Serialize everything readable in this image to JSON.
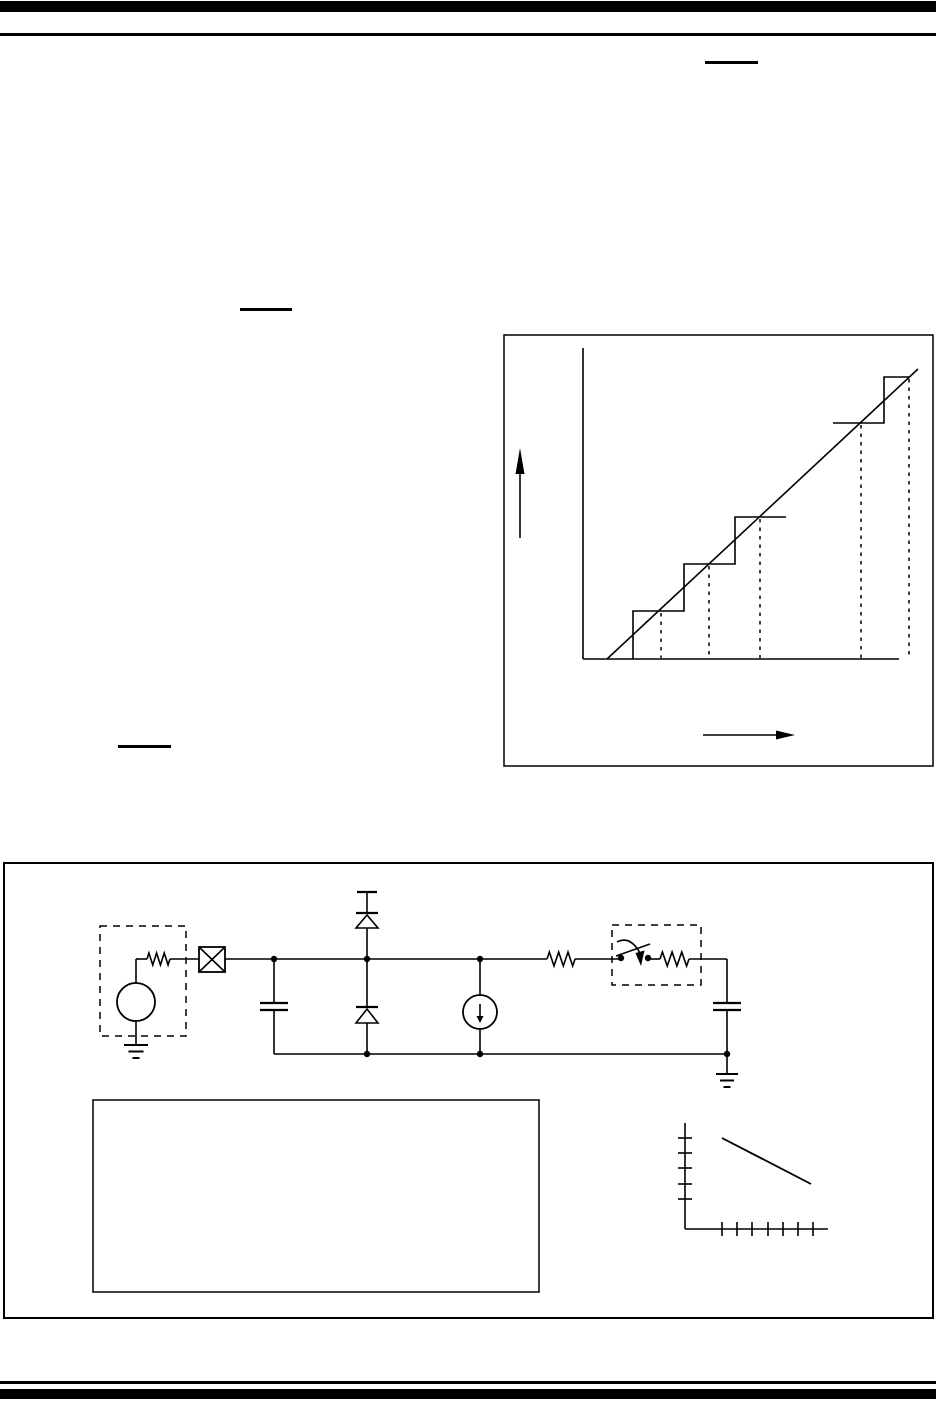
{
  "page": {
    "width": 936,
    "height": 1412,
    "background": "#ffffff",
    "ink": "#000000"
  },
  "rules": [
    {
      "name": "top-thick-bar",
      "x": 0,
      "y": 1,
      "w": 936,
      "h": 11
    },
    {
      "name": "top-thin-rule",
      "x": 0,
      "y": 33,
      "w": 936,
      "h": 3
    },
    {
      "name": "bottom-thin-rule",
      "x": 0,
      "y": 1381,
      "w": 936,
      "h": 3
    },
    {
      "name": "bottom-thick-bar",
      "x": 0,
      "y": 1389,
      "w": 936,
      "h": 10
    }
  ],
  "underlines": [
    {
      "name": "reference-underline-top-right",
      "x": 705,
      "y": 61,
      "w": 53,
      "h": 3
    },
    {
      "name": "reference-underline-mid-left",
      "x": 240,
      "y": 308,
      "w": 52,
      "h": 3
    },
    {
      "name": "reference-underline-lower-left",
      "x": 118,
      "y": 745,
      "w": 53,
      "h": 3
    }
  ],
  "adc_figure": {
    "frame": {
      "x": 504,
      "y": 335,
      "w": 429,
      "h": 431,
      "stroke_w": 1.5
    },
    "y_axis": {
      "x": 583,
      "y1": 348,
      "y2": 659
    },
    "x_axis": {
      "y": 659,
      "x1": 583,
      "x2": 899
    },
    "up_arrow": {
      "x": 520,
      "shaft_y1": 538,
      "shaft_y2": 472,
      "tip_y": 448,
      "base_y": 474,
      "half_w": 4.5
    },
    "right_arrow": {
      "y": 735,
      "shaft_x1": 703,
      "shaft_x2": 778,
      "tip_x": 795,
      "base_x": 776,
      "half_h": 4.5
    },
    "ideal_line": {
      "x1": 607,
      "y1": 659,
      "x2": 918,
      "y2": 369
    },
    "staircase_lower": "633,659 633,611 684,611 684,564 735,564 735,517 786,517",
    "staircase_upper": "833,423 884,423 884,377 909,377",
    "dashed_guides": [
      {
        "x": 661,
        "y1": 613,
        "y2": 658
      },
      {
        "x": 709,
        "y1": 566,
        "y2": 658
      },
      {
        "x": 760,
        "y1": 519,
        "y2": 658
      },
      {
        "x": 861,
        "y1": 425,
        "y2": 658
      },
      {
        "x": 909,
        "y1": 379,
        "y2": 658
      }
    ]
  },
  "circuit_figure": {
    "frame": {
      "x": 4,
      "y": 863,
      "w": 929,
      "h": 455,
      "stroke_w": 2
    },
    "source_dashed_box": {
      "x": 100,
      "y": 926,
      "w": 86,
      "h": 110
    },
    "switch_dashed_box": {
      "x": 612,
      "y": 925,
      "w": 89,
      "h": 60
    },
    "legend_box": {
      "x": 93,
      "y": 1100,
      "w": 446,
      "h": 192,
      "stroke_w": 1.5
    },
    "source_circle": {
      "cx": 136,
      "cy": 1002,
      "r": 19
    },
    "pin_box": {
      "x": 199,
      "y": 947,
      "w": 26,
      "h": 25
    },
    "wires": [
      [
        136,
        983,
        136,
        959
      ],
      [
        136,
        959,
        147,
        959
      ],
      [
        170,
        959,
        199,
        959
      ],
      [
        225,
        959,
        547,
        959
      ],
      [
        575,
        959,
        621,
        959
      ],
      [
        648,
        959,
        660,
        959
      ],
      [
        689,
        959,
        727,
        959
      ],
      [
        727,
        959,
        727,
        1003
      ],
      [
        727,
        1010,
        727,
        1054
      ],
      [
        274,
        959,
        274,
        1003
      ],
      [
        274,
        1010,
        274,
        1054
      ],
      [
        274,
        1054,
        727,
        1054
      ],
      [
        367,
        959,
        367,
        928
      ],
      [
        367,
        913,
        367,
        892
      ],
      [
        367,
        959,
        367,
        1007
      ],
      [
        367,
        1023,
        367,
        1054
      ],
      [
        480,
        959,
        480,
        995
      ],
      [
        480,
        1029,
        480,
        1054
      ],
      [
        727,
        1054,
        727,
        1074
      ],
      [
        136,
        1021,
        136,
        1045
      ]
    ],
    "resistors": [
      {
        "name": "source-resistor",
        "x1": 147,
        "x2": 170,
        "y": 959,
        "amp": 6
      },
      {
        "name": "interconnect-resistor",
        "x1": 547,
        "x2": 575,
        "y": 959,
        "amp": 7
      },
      {
        "name": "sampling-resistor",
        "x1": 660,
        "x2": 689,
        "y": 959,
        "amp": 7
      }
    ],
    "capacitors": [
      {
        "name": "pin-capacitor",
        "cx": 274,
        "y_top": 1003,
        "y_bot": 1010,
        "half_w": 14
      },
      {
        "name": "hold-capacitor",
        "cx": 727,
        "y_top": 1003,
        "y_bot": 1010,
        "half_w": 14
      }
    ],
    "diodes": [
      {
        "name": "clamp-diode-to-vdd",
        "cx": 367,
        "bar_y": 913,
        "apex_y": 915,
        "base_y": 928,
        "half_w": 11
      },
      {
        "name": "clamp-diode-to-vss",
        "cx": 367,
        "bar_y": 1007,
        "apex_y": 1009,
        "base_y": 1023,
        "half_w": 11
      }
    ],
    "vdd_tick": {
      "x1": 357,
      "x2": 377,
      "y": 892
    },
    "current_source": {
      "cx": 480,
      "cy": 1012,
      "r": 17,
      "arrow_y1": 1004,
      "arrow_y2": 1017,
      "tip_y": 1023,
      "half_w": 3.5
    },
    "grounds": [
      {
        "name": "source-ground",
        "cx": 136,
        "top_y": 1045,
        "widths": [
          24,
          15,
          7
        ],
        "gap": 6.5
      },
      {
        "name": "hold-ground",
        "cx": 727,
        "top_y": 1074,
        "widths": [
          22,
          14,
          7
        ],
        "gap": 6.5
      }
    ],
    "junction_dots": [
      [
        274,
        959
      ],
      [
        367,
        959
      ],
      [
        480,
        959
      ],
      [
        621,
        958
      ],
      [
        648,
        958
      ],
      [
        367,
        1054
      ],
      [
        480,
        1054
      ],
      [
        727,
        1054
      ]
    ],
    "dot_r": 3.2,
    "switch": {
      "blade": [
        616,
        956,
        650,
        944
      ],
      "arc": "M 617 942 Q 630 935 640 953",
      "arrow_head": [
        [
          635.5,
          953
        ],
        [
          644.5,
          950.5
        ],
        [
          641,
          966
        ]
      ]
    },
    "discharge_graph": {
      "y_axis": {
        "x": 685,
        "y1": 1123,
        "y2": 1229
      },
      "x_axis": {
        "y": 1229,
        "x1": 685,
        "x2": 828
      },
      "y_ticks": {
        "ys": [
          1138,
          1153,
          1168,
          1184,
          1199
        ],
        "x1": 678,
        "x2": 692
      },
      "x_ticks": {
        "xs": [
          722,
          737,
          752,
          768,
          783,
          798,
          813
        ],
        "y1": 1222,
        "y2": 1236
      },
      "curve": {
        "x1": 722,
        "y1": 1138,
        "x2": 811,
        "y2": 1184
      }
    }
  },
  "chart_data": [
    {
      "type": "line",
      "title": "",
      "xlabel": "",
      "ylabel": "",
      "description": "Ideal A/D transfer function: quantization staircase with ideal straight line; dashed verticals mark code-transition crossings; axes unlabeled in pixels",
      "series": [
        {
          "name": "staircase-lower",
          "points_px": [
            [
              633,
              659
            ],
            [
              633,
              611
            ],
            [
              684,
              611
            ],
            [
              684,
              564
            ],
            [
              735,
              564
            ],
            [
              735,
              517
            ],
            [
              786,
              517
            ]
          ]
        },
        {
          "name": "staircase-upper",
          "points_px": [
            [
              833,
              423
            ],
            [
              884,
              423
            ],
            [
              884,
              377
            ],
            [
              909,
              377
            ]
          ]
        },
        {
          "name": "ideal-line",
          "points_px": [
            [
              607,
              659
            ],
            [
              918,
              369
            ]
          ]
        }
      ],
      "dashed_guides_x_px": [
        661,
        709,
        760,
        861,
        909
      ],
      "step_width_px": 51,
      "step_height_px": 47,
      "legend_position": "none",
      "grid": false
    },
    {
      "type": "line",
      "title": "",
      "xlabel": "",
      "ylabel": "",
      "description": "Small decay-line plot at lower right of circuit figure; 5 y-ticks, 7 x-ticks, axes unlabeled",
      "series": [
        {
          "name": "decay-line",
          "points_px": [
            [
              722,
              1138
            ],
            [
              811,
              1184
            ]
          ]
        }
      ],
      "y_tick_count": 5,
      "x_tick_count": 7,
      "legend_position": "none",
      "grid": false
    }
  ]
}
